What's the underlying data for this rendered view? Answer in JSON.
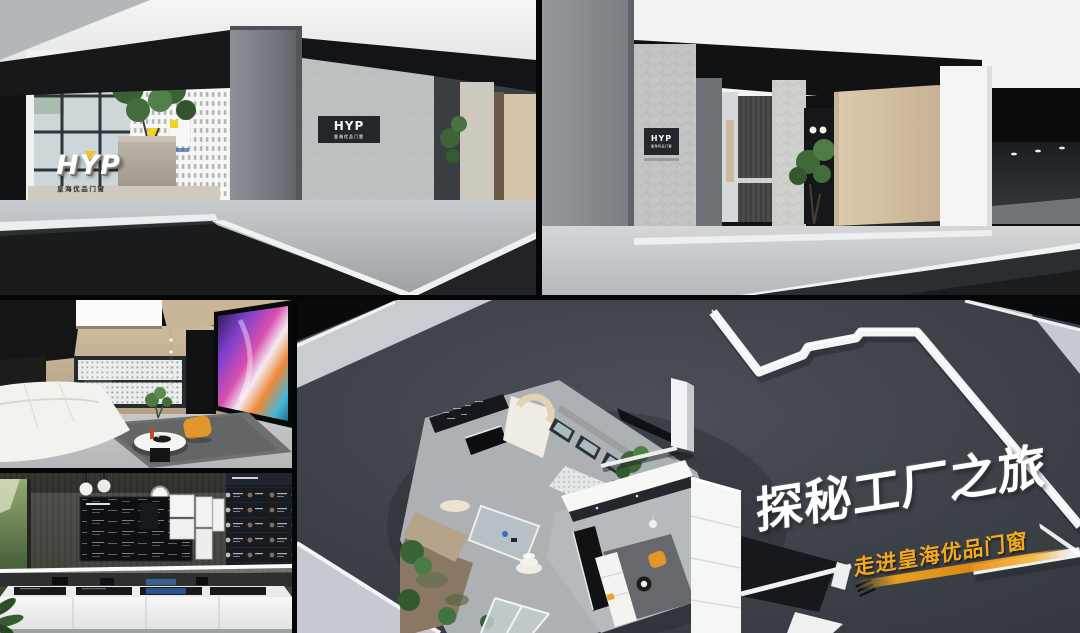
{
  "brand": {
    "logo_text": "HYP",
    "logo_subtext": "皇海优品门窗"
  },
  "signs": {
    "entrance_left_wall_sign": "HYP",
    "entrance_left_wall_sign_sub": "皇海优品门窗",
    "entrance_right_wall_sign": "HYP",
    "entrance_right_wall_sign_sub": "皇海优品门窗"
  },
  "campaign": {
    "headline": "探秘工厂之旅",
    "subheadline": "走进皇海优品门窗"
  },
  "colors": {
    "collage_background": "#060606",
    "plan_floor": "#3f444b",
    "plan_walkway": "#c9ced3",
    "accent_yellow": "#f5a91c",
    "poster_yellow": "#efd325",
    "door_beige": "#d6c3a6",
    "chair_orange": "#e2952a",
    "tv_magenta": "#d84fae",
    "foliage_green": "#3f6b3a"
  }
}
